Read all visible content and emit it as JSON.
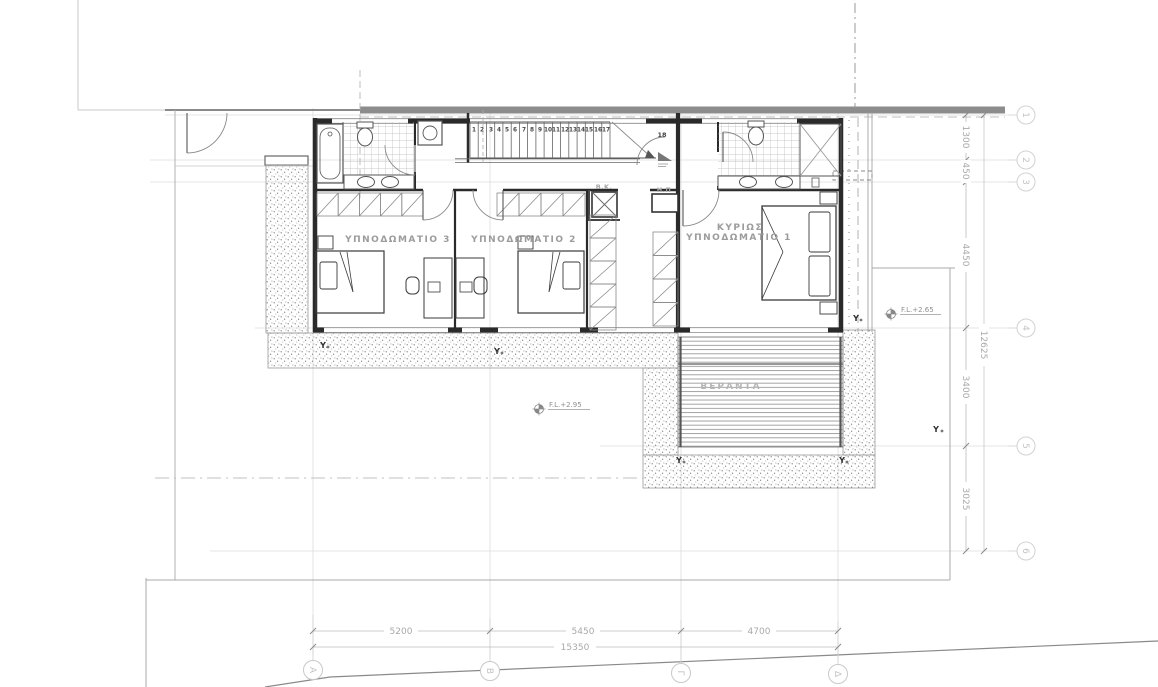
{
  "plan": {
    "rooms": {
      "bedroom3": "ΥΠΝΟΔΩΜΑΤΙΟ 3",
      "bedroom2": "ΥΠΝΟΔΩΜΑΤΙΟ 2",
      "master_line1": "ΚΥΡΙΩΣ",
      "master_line2": "ΥΠΝΟΔΩΜΑΤΙΟ 1",
      "veranda": "ΒΕΡΑΝΤΑ"
    },
    "annotations": {
      "shaft": "Β.Κ.",
      "panel": "Η.Π",
      "floor_level_main": "F.L.+2.95",
      "floor_level_terrace": "F.L.+2.65",
      "column_marker": "Y",
      "landing_number": "18"
    },
    "stairs": {
      "treads": [
        "1",
        "2",
        "3",
        "4",
        "5",
        "6",
        "7",
        "8",
        "9",
        "10",
        "11",
        "12",
        "13",
        "14",
        "15",
        "16",
        "17"
      ]
    },
    "grid": {
      "column_bubbles": [
        "Α",
        "Β",
        "Γ",
        "Δ"
      ],
      "row_bubbles": [
        "1",
        "2",
        "3",
        "4",
        "5",
        "6"
      ]
    },
    "dimensions": {
      "bottom_segments": [
        "5200",
        "5450",
        "4700"
      ],
      "bottom_total": "15350",
      "right_segments": [
        "1300",
        "450",
        "4450",
        "3400",
        "3025"
      ],
      "right_total": "12625"
    },
    "colors": {
      "wall": "#2a2a2a",
      "light_line": "#c9c9c9",
      "text_gray": "#9c9c9c"
    }
  }
}
